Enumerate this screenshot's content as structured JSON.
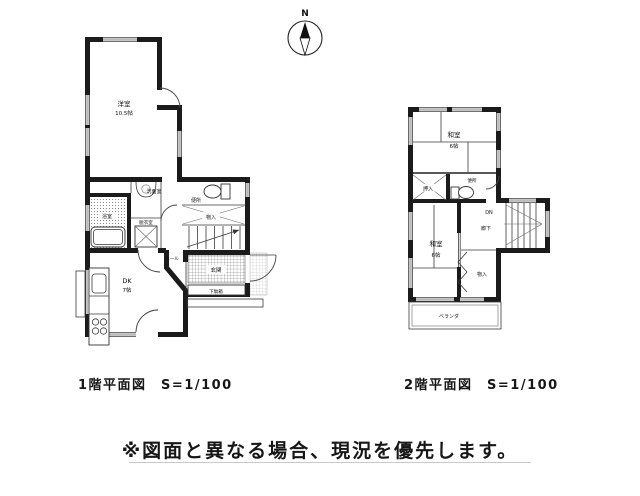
{
  "page": {
    "background": "#ffffff"
  },
  "compass": {
    "north_label": "N"
  },
  "floor1": {
    "caption": "1階平面図　S=1/100",
    "rooms": {
      "western_room": {
        "name": "洋室",
        "size": "10.5帖"
      },
      "washroom": {
        "name": "洗面室"
      },
      "toilet": {
        "name": "便所"
      },
      "bathroom": {
        "name": "浴室"
      },
      "dressing_room": {
        "name": "脱衣室"
      },
      "storage": {
        "name": "物入"
      },
      "hall": {
        "name": "ホール"
      },
      "entrance": {
        "name": "玄関"
      },
      "shoe_cabinet": {
        "name": "下駄箱"
      },
      "dining_kitchen": {
        "name": "DK",
        "size": "7帖"
      }
    }
  },
  "floor2": {
    "caption": "2階平面図　S=1/100",
    "rooms": {
      "japanese_room_north": {
        "name": "和室",
        "size": "6帖"
      },
      "closet": {
        "name": "押入"
      },
      "toilet": {
        "name": "便所"
      },
      "stairs_down": {
        "name": "DN"
      },
      "corridor": {
        "name": "廊下"
      },
      "japanese_room_south": {
        "name": "和室",
        "size": "6帖"
      },
      "storage": {
        "name": "物入"
      },
      "veranda": {
        "name": "ベランダ"
      }
    }
  },
  "disclaimer": "※図面と異なる場合、現況を優先します。",
  "colors": {
    "wall": "#1b1b1b",
    "thin_line": "#3a3a3a",
    "text": "#161616",
    "underline": "#c9c9c9"
  }
}
